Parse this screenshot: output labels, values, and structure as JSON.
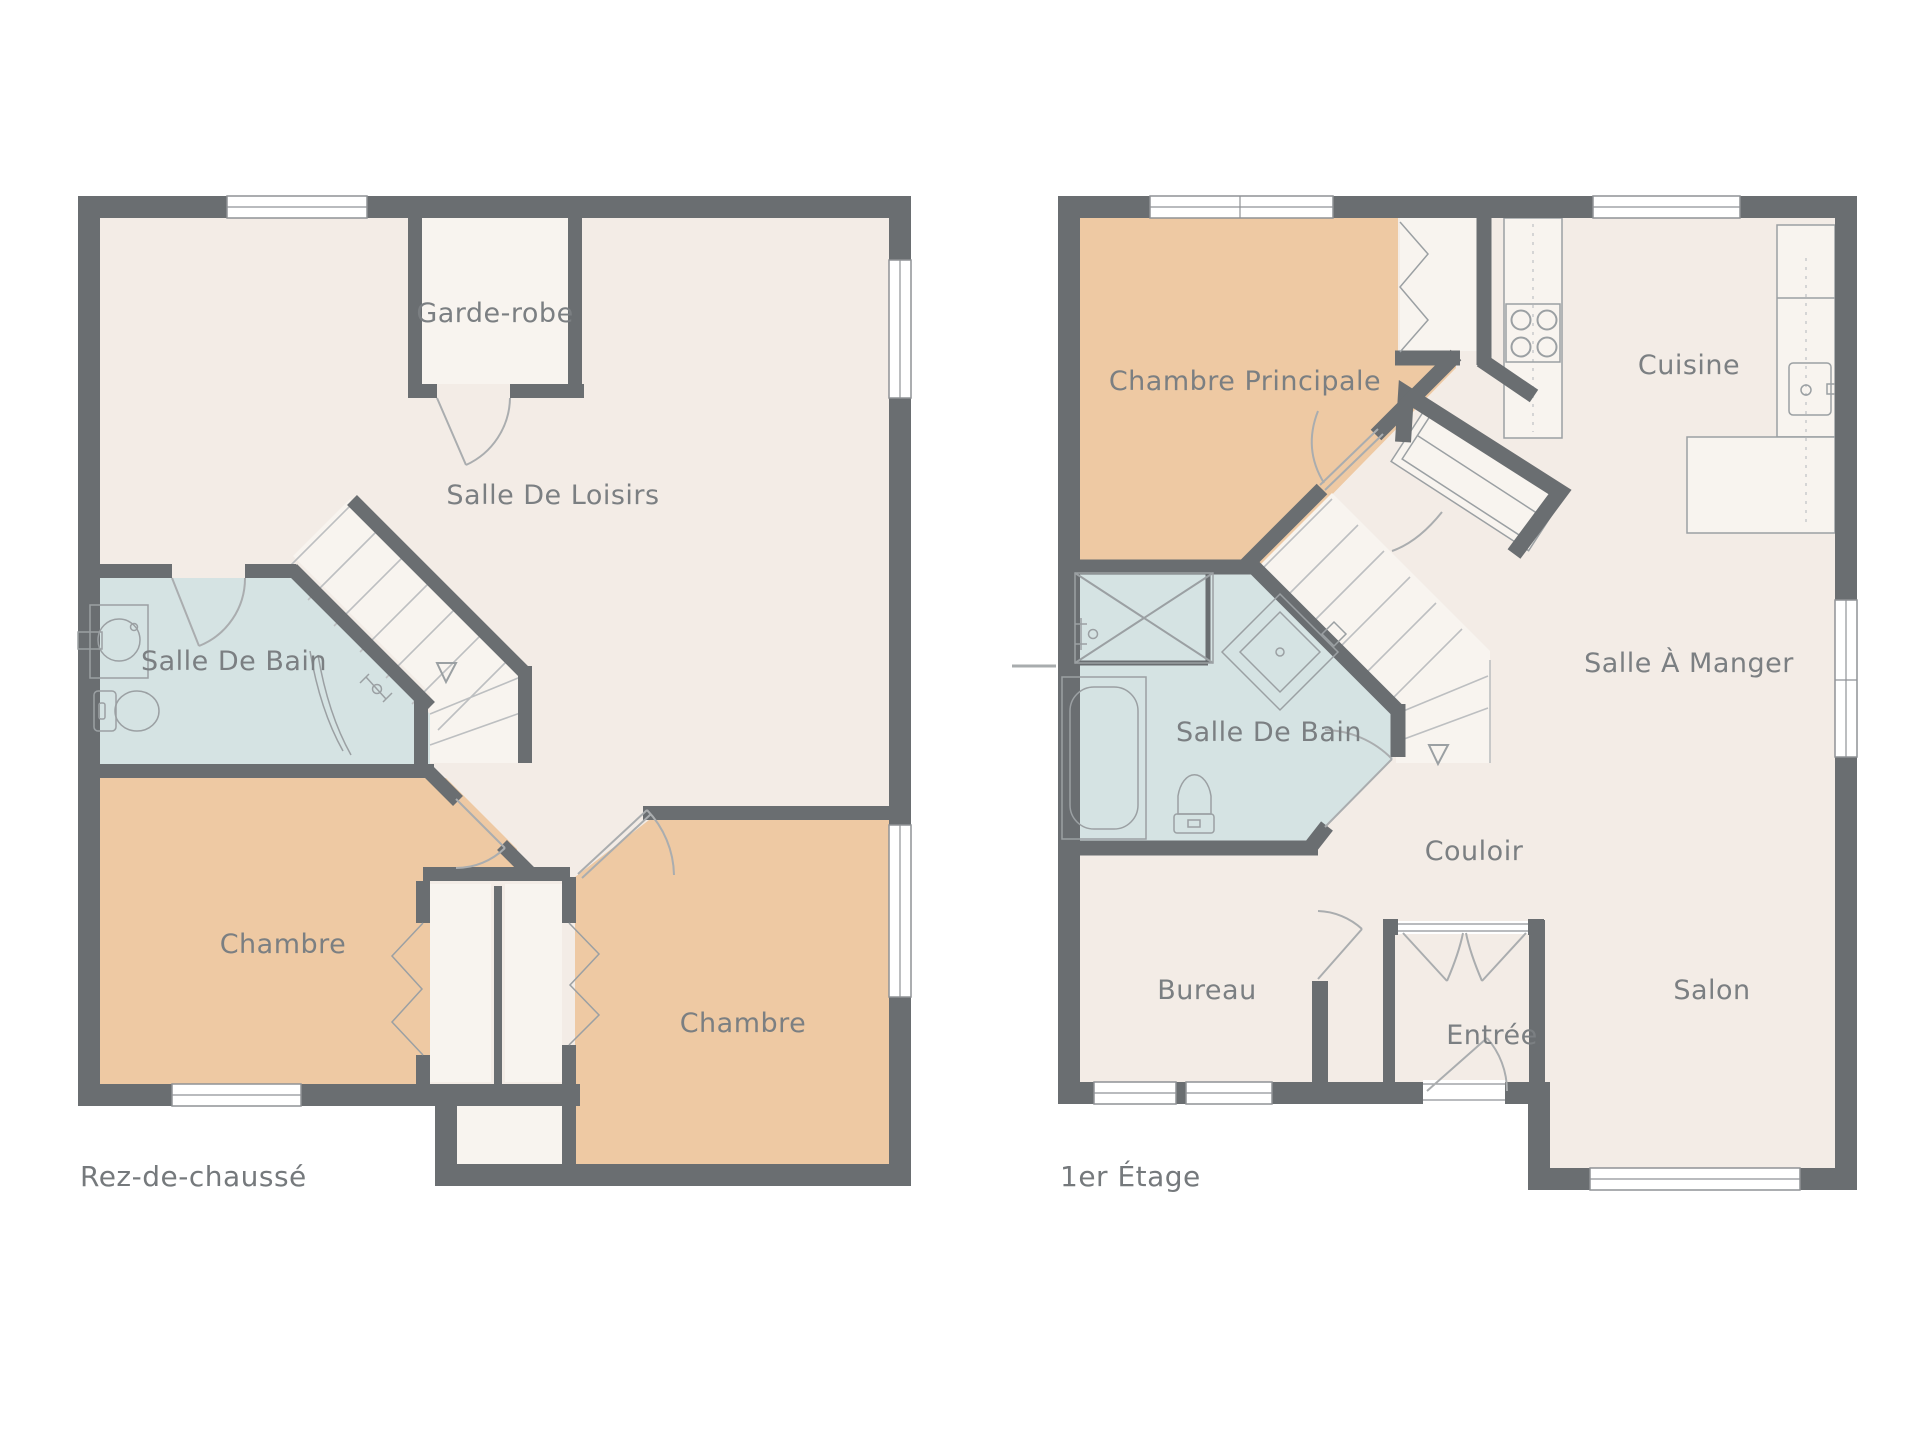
{
  "palette": {
    "background": "#ffffff",
    "wall_gray": "#6a6e71",
    "floor_beige": "#f3ece6",
    "floor_light": "#f8f4ef",
    "bedroom_orange": "#eec9a3",
    "bathroom_blue": "#d5e3e3",
    "label_gray": "#7b7f82"
  },
  "floors": [
    {
      "title": "Rez-de-chaussé",
      "rooms": [
        {
          "label": "Garde-robe"
        },
        {
          "label": "Salle De Loisirs"
        },
        {
          "label": "Salle De Bain"
        },
        {
          "label": "Chambre"
        },
        {
          "label": "Chambre"
        }
      ]
    },
    {
      "title": "1er Étage",
      "rooms": [
        {
          "label": "Chambre Principale"
        },
        {
          "label": "Cuisine"
        },
        {
          "label": "Salle À Manger"
        },
        {
          "label": "Salle De Bain"
        },
        {
          "label": "Couloir"
        },
        {
          "label": "Bureau"
        },
        {
          "label": "Entrée"
        },
        {
          "label": "Salon"
        }
      ]
    }
  ]
}
